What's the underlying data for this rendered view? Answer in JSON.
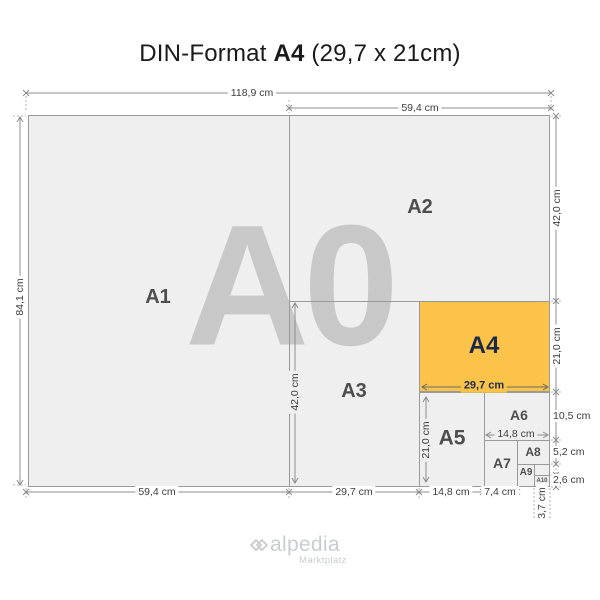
{
  "title": {
    "prefix": "DIN-Format",
    "format": "A4",
    "suffix": "(29,7 x 21cm)"
  },
  "colors": {
    "paper_fill": "#EFEFEF",
    "border_line": "#9A9A9A",
    "watermark_gray": "#C8C8C8",
    "highlight_orange": "#FBC34A",
    "highlight_label_navy": "#1B2A49",
    "label_gray": "#4D4D4D",
    "logo_gray": "#C9CDD1"
  },
  "diagram": {
    "watermark": "A0",
    "labels": {
      "a1": "A1",
      "a2": "A2",
      "a3": "A3",
      "a4": "A4",
      "a5": "A5",
      "a6": "A6",
      "a7": "A7",
      "a8": "A8",
      "a9": "A9",
      "a10": "A10"
    },
    "dimensions": {
      "top_width_a0": "118,9 cm",
      "top_width_a2": "59,4 cm",
      "left_height_a0": "84,1 cm",
      "right_height_a2": "42,0 cm",
      "right_height_a4": "21,0 cm",
      "right_height_a6": "10,5 cm",
      "right_height_a8": "5,2 cm",
      "right_height_a10": "2,6 cm",
      "bottom_width_a1": "59,4 cm",
      "bottom_width_a3": "29,7 cm",
      "bottom_width_a5": "14,8 cm",
      "bottom_width_a7": "7,4 cm",
      "bottom_width_a10": "3,7 cm",
      "inner_height_a3": "42,0 cm",
      "inner_height_a5": "21,0 cm",
      "inner_width_a4": "29,7 cm",
      "inner_width_a6": "14,8 cm"
    }
  },
  "footer": {
    "logo_text": "alpedia",
    "logo_subtext": "Marktplatz"
  }
}
